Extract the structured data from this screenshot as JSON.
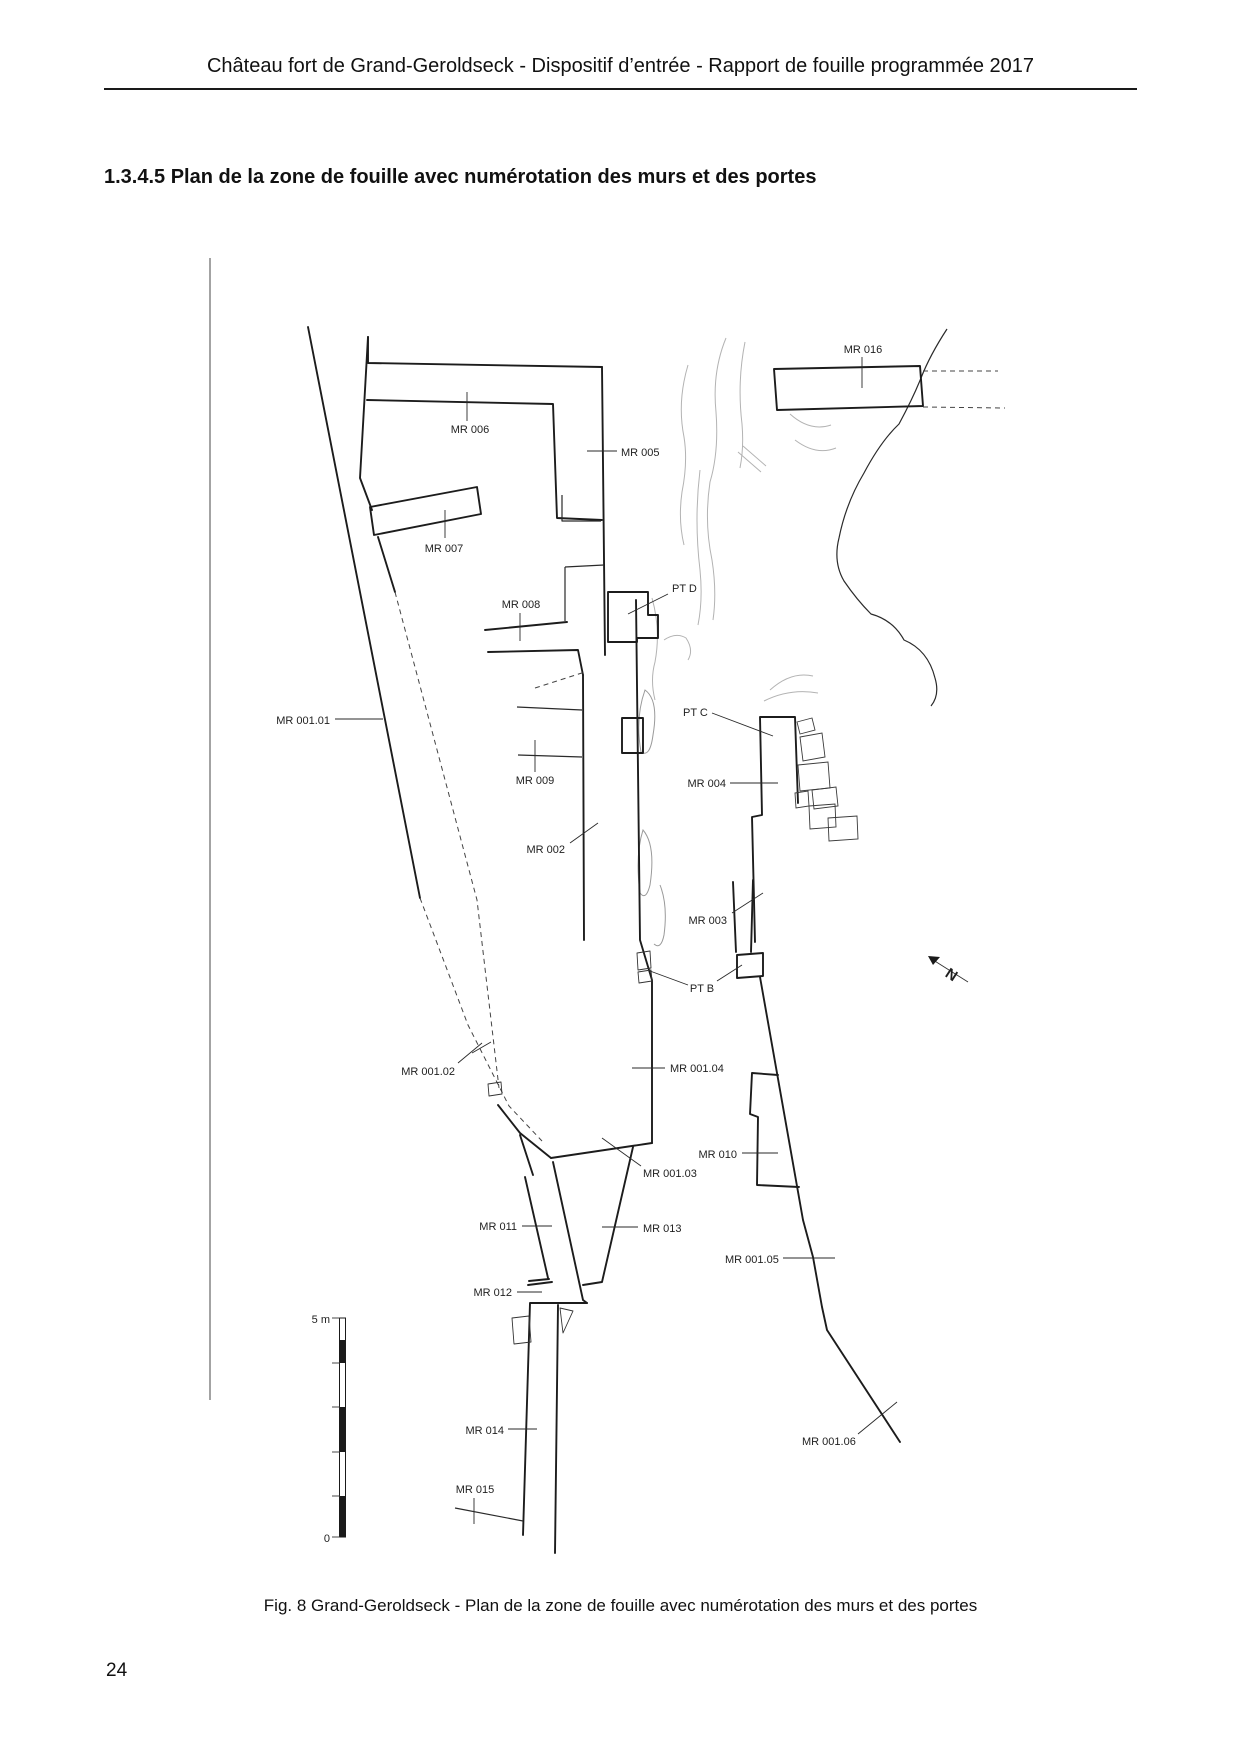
{
  "page": {
    "header": "Château fort de Grand-Geroldseck - Dispositif d’entrée - Rapport de fouille programmée 2017",
    "section_heading": "1.3.4.5 Plan de la zone de fouille avec numérotation des murs et des portes",
    "caption": "Fig. 8 Grand-Geroldseck - Plan de la zone de fouille avec numérotation des murs et des portes",
    "page_number": "24"
  },
  "figure": {
    "north_label": "N",
    "scale_bar": {
      "top": "5 m",
      "bottom": "0"
    },
    "labels": [
      {
        "id": "MR016",
        "text": "MR 016"
      },
      {
        "id": "MR006",
        "text": "MR 006"
      },
      {
        "id": "MR005",
        "text": "MR 005"
      },
      {
        "id": "MR007",
        "text": "MR 007"
      },
      {
        "id": "MR008",
        "text": "MR 008"
      },
      {
        "id": "PTD",
        "text": "PT D"
      },
      {
        "id": "MR001_01",
        "text": "MR 001.01"
      },
      {
        "id": "PTC",
        "text": "PT C"
      },
      {
        "id": "MR009",
        "text": "MR 009"
      },
      {
        "id": "MR004",
        "text": "MR 004"
      },
      {
        "id": "MR002",
        "text": "MR 002"
      },
      {
        "id": "MR003",
        "text": "MR 003"
      },
      {
        "id": "PTB",
        "text": "PT B"
      },
      {
        "id": "MR001_02",
        "text": "MR 001.02"
      },
      {
        "id": "MR001_04",
        "text": "MR 001.04"
      },
      {
        "id": "MR010",
        "text": "MR 010"
      },
      {
        "id": "MR001_03",
        "text": "MR 001.03"
      },
      {
        "id": "MR011",
        "text": "MR 011"
      },
      {
        "id": "MR013",
        "text": "MR 013"
      },
      {
        "id": "MR001_05",
        "text": "MR 001.05"
      },
      {
        "id": "MR012",
        "text": "MR 012"
      },
      {
        "id": "MR014",
        "text": "MR 014"
      },
      {
        "id": "MR001_06",
        "text": "MR 001.06"
      },
      {
        "id": "MR015",
        "text": "MR 015"
      }
    ]
  }
}
